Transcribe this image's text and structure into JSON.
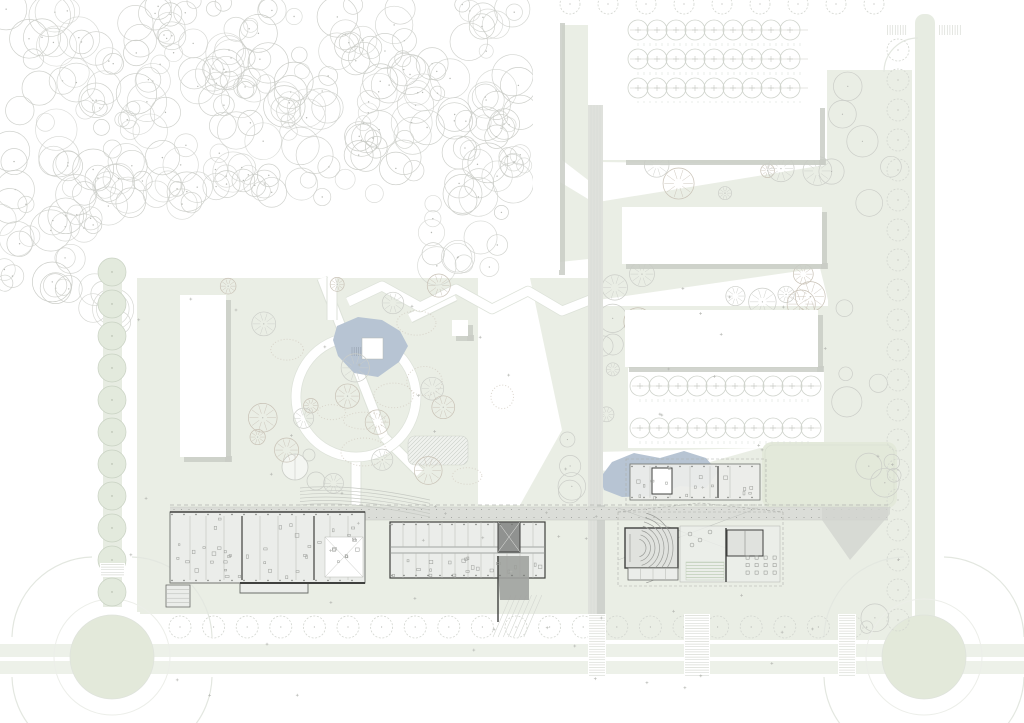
{
  "canvas": {
    "w": 1024,
    "h": 723
  },
  "palette": {
    "paper": "#ffffff",
    "green": "#eaeee5",
    "green2": "#e3e9da",
    "stripe": "#edf1e9",
    "band": "#e7ece2",
    "tree_fill": "#e3eadd",
    "tree_fill_stroke": "#c9d2c3",
    "tree_stroke": "#cbcdc8",
    "tree_dash": "#d3d6d0",
    "tree_warm": "#c8c1b5",
    "shadow": "#c9ccc6",
    "wall_dark": "#3f403e",
    "wall_mid": "#8a8c88",
    "hair": "#b6b8b3",
    "floor": "#ebedea",
    "floor2": "#e0e2de",
    "water": "#b7c4d3",
    "corridor": "#dbddd8",
    "spine": "#dfe1dc",
    "plaza": "#d2d5d0",
    "dot": "#9a9c97",
    "curb": "#e3e7e0",
    "mark": "#b4b6b1"
  },
  "forest": {
    "seed": 7,
    "r_min": 7,
    "r_max": 21,
    "regions": [
      {
        "x": 0,
        "y": 0,
        "w": 525,
        "h": 148,
        "n": 175
      },
      {
        "x": 0,
        "y": 148,
        "w": 95,
        "h": 150,
        "n": 34
      },
      {
        "x": 95,
        "y": 148,
        "w": 110,
        "h": 75,
        "n": 22
      },
      {
        "x": 205,
        "y": 148,
        "w": 230,
        "h": 50,
        "n": 26
      },
      {
        "x": 428,
        "y": 148,
        "w": 97,
        "h": 85,
        "n": 22
      },
      {
        "x": 55,
        "y": 288,
        "w": 90,
        "h": 35,
        "n": 7
      },
      {
        "x": 430,
        "y": 228,
        "w": 70,
        "h": 40,
        "n": 8
      }
    ],
    "exclude": {
      "cx": 262,
      "cy": 262,
      "rx": 158,
      "ry": 62
    }
  },
  "greens": [
    {
      "pts": [
        [
          137,
          278
        ],
        [
          620,
          278
        ],
        [
          620,
          612
        ],
        [
          137,
          612
        ]
      ]
    },
    {
      "pts": [
        [
          598,
          160
        ],
        [
          828,
          160
        ],
        [
          828,
          640
        ],
        [
          598,
          640
        ]
      ]
    },
    {
      "pts": [
        [
          827,
          70
        ],
        [
          912,
          70
        ],
        [
          912,
          640
        ],
        [
          827,
          640
        ]
      ]
    },
    {
      "pts": [
        [
          562,
          25
        ],
        [
          588,
          25
        ],
        [
          588,
          180
        ],
        [
          562,
          160
        ]
      ]
    },
    {
      "pts": [
        [
          560,
          182
        ],
        [
          598,
          205
        ],
        [
          598,
          258
        ],
        [
          560,
          262
        ]
      ]
    },
    {
      "pts": [
        [
          560,
          380
        ],
        [
          598,
          408
        ],
        [
          598,
          462
        ],
        [
          560,
          470
        ]
      ]
    },
    {
      "pts": [
        [
          140,
          597
        ],
        [
          880,
          597
        ],
        [
          880,
          614
        ],
        [
          140,
          614
        ]
      ]
    }
  ],
  "white_cuts": [
    {
      "pts": [
        [
          122,
          262
        ],
        [
          137,
          262
        ],
        [
          137,
          612
        ],
        [
          122,
          612
        ]
      ]
    },
    {
      "pts": [
        [
          598,
          162
        ],
        [
          825,
          165
        ],
        [
          598,
          202
        ]
      ]
    },
    {
      "pts": [
        [
          598,
          300
        ],
        [
          820,
          268
        ],
        [
          828,
          300
        ],
        [
          828,
          306
        ],
        [
          598,
          306
        ]
      ]
    },
    {
      "pts": [
        [
          628,
          368
        ],
        [
          824,
          368
        ],
        [
          824,
          448
        ],
        [
          628,
          448
        ]
      ]
    },
    {
      "pts": [
        [
          598,
          452
        ],
        [
          760,
          448
        ],
        [
          660,
          476
        ],
        [
          598,
          470
        ]
      ]
    },
    {
      "pts": [
        [
          478,
          278
        ],
        [
          530,
          278
        ],
        [
          562,
          430
        ],
        [
          520,
          505
        ],
        [
          478,
          505
        ]
      ]
    }
  ],
  "sport_field": {
    "x": 762,
    "y": 442,
    "w": 135,
    "h": 66,
    "rx": 10
  },
  "roads": {
    "left_band": {
      "x": 103,
      "y": 262,
      "w": 19,
      "h": 345
    },
    "right_band": {
      "x": 915,
      "y": 14,
      "w": 20,
      "h": 626
    },
    "south_stripes": [
      {
        "x": 0,
        "y": 644,
        "w": 1024,
        "h": 13
      },
      {
        "x": 0,
        "y": 661,
        "w": 1024,
        "h": 13
      }
    ],
    "roundabouts": [
      {
        "cx": 112,
        "cy": 657,
        "r": 42
      },
      {
        "cx": 924,
        "cy": 657,
        "r": 42
      }
    ],
    "corner_arc": {
      "x1": 884,
      "y1": 72,
      "x2": 918,
      "y2": 38
    }
  },
  "tree_rows": [
    {
      "kind": "filled",
      "axis": "v",
      "x": 112,
      "y0": 272,
      "y1": 592,
      "step": 32,
      "r": 14
    },
    {
      "kind": "dashed",
      "axis": "v",
      "x": 898,
      "y0": 50,
      "y1": 620,
      "step": 30,
      "r": 11
    },
    {
      "kind": "dashed",
      "axis": "h",
      "y": 627,
      "x0": 180,
      "x1": 856,
      "step": 33.6,
      "r": 11
    },
    {
      "kind": "dashed",
      "axis": "h",
      "y": 4,
      "x0": 570,
      "x1": 900,
      "step": 38,
      "r": 10
    },
    {
      "kind": "parking",
      "y": 30,
      "x0": 638,
      "x1": 800,
      "step": 19,
      "r": 10
    },
    {
      "kind": "parking",
      "y": 59,
      "x0": 638,
      "x1": 800,
      "step": 19,
      "r": 10
    },
    {
      "kind": "parking",
      "y": 88,
      "x0": 638,
      "x1": 800,
      "step": 19,
      "r": 10
    },
    {
      "kind": "parking",
      "y": 386,
      "x0": 640,
      "x1": 812,
      "step": 19,
      "r": 10
    },
    {
      "kind": "parking",
      "y": 428,
      "x0": 640,
      "x1": 812,
      "step": 19,
      "r": 10
    }
  ],
  "scatter_trees": [
    {
      "x": 640,
      "y": 162,
      "w": 180,
      "h": 42,
      "n": 6,
      "kind": "spoke"
    },
    {
      "x": 640,
      "y": 266,
      "w": 180,
      "h": 40,
      "n": 7,
      "kind": "spoke"
    },
    {
      "x": 830,
      "y": 80,
      "w": 66,
      "h": 550,
      "n": 16,
      "kind": "plain"
    },
    {
      "x": 600,
      "y": 312,
      "w": 26,
      "h": 54,
      "n": 3,
      "kind": "plain"
    },
    {
      "x": 560,
      "y": 430,
      "w": 40,
      "h": 78,
      "n": 4,
      "kind": "plain"
    },
    {
      "x": 205,
      "y": 282,
      "w": 460,
      "h": 215,
      "n": 24,
      "kind": "spoke"
    }
  ],
  "stipples": {
    "n": 9,
    "x": 230,
    "y": 300,
    "w": 320,
    "h": 180
  },
  "plus_marks": [
    {
      "x": 130,
      "y": 285,
      "w": 770,
      "h": 330,
      "n": 46
    },
    {
      "x": 150,
      "y": 596,
      "w": 740,
      "h": 100,
      "n": 18
    }
  ],
  "slabs": [
    {
      "x": 533,
      "y": 18,
      "w": 27,
      "h": 252,
      "shadow": "r"
    },
    {
      "x": 622,
      "y": 103,
      "w": 198,
      "h": 57,
      "shadow": "rb"
    },
    {
      "x": 622,
      "y": 207,
      "w": 200,
      "h": 57,
      "shadow": "rb"
    },
    {
      "x": 625,
      "y": 310,
      "w": 193,
      "h": 57,
      "shadow": "rb"
    },
    {
      "x": 180,
      "y": 295,
      "w": 46,
      "h": 162,
      "shadow": "rb"
    },
    {
      "x": 452,
      "y": 320,
      "w": 16,
      "h": 16,
      "shadow": "rb"
    }
  ],
  "park": {
    "ring": {
      "cx": 356,
      "cy": 397,
      "r": 60,
      "w": 9
    },
    "paths": [
      [
        [
          322,
          278
        ],
        [
          384,
          437
        ]
      ],
      [
        [
          332,
          278
        ],
        [
          332,
          320
        ]
      ],
      [
        [
          410,
          318
        ],
        [
          455,
          296
        ]
      ],
      [
        [
          384,
          437
        ],
        [
          420,
          473
        ]
      ],
      [
        [
          356,
          457
        ],
        [
          356,
          505
        ]
      ]
    ],
    "zigzag": [
      [
        348,
        302
      ],
      [
        382,
        286
      ],
      [
        420,
        307
      ],
      [
        456,
        289
      ],
      [
        492,
        309
      ],
      [
        528,
        291
      ],
      [
        562,
        311
      ],
      [
        600,
        296
      ]
    ],
    "pond1": [
      [
        337,
        326
      ],
      [
        358,
        317
      ],
      [
        382,
        320
      ],
      [
        400,
        331
      ],
      [
        408,
        346
      ],
      [
        399,
        362
      ],
      [
        378,
        377
      ],
      [
        354,
        373
      ],
      [
        338,
        356
      ],
      [
        333,
        340
      ]
    ],
    "pond1_square": {
      "x": 362,
      "y": 338,
      "w": 21,
      "h": 21
    },
    "pond2": [
      [
        600,
        478
      ],
      [
        612,
        462
      ],
      [
        634,
        453
      ],
      [
        660,
        458
      ],
      [
        684,
        451
      ],
      [
        706,
        458
      ],
      [
        718,
        472
      ],
      [
        706,
        488
      ],
      [
        680,
        486
      ],
      [
        652,
        496
      ],
      [
        622,
        497
      ],
      [
        604,
        490
      ]
    ],
    "greenhouse": {
      "x": 408,
      "y": 436,
      "w": 60,
      "h": 29,
      "rx": 7
    },
    "court": {
      "cx": 295,
      "cy": 467,
      "r": 13
    },
    "court2": {
      "cx": 316,
      "cy": 481,
      "r": 9
    },
    "court3": {
      "cx": 309,
      "cy": 455,
      "r": 6
    }
  },
  "campus": {
    "corridor": {
      "x": 170,
      "y": 507,
      "w": 718,
      "h": 13
    },
    "spine": {
      "x": 588,
      "y": 105,
      "w": 15,
      "h": 570
    },
    "plaza_wedge": [
      [
        822,
        507
      ],
      [
        890,
        507
      ],
      [
        890,
        514
      ],
      [
        850,
        560
      ],
      [
        822,
        520
      ]
    ],
    "plaza_x": [
      [
        618,
        560
      ],
      [
        758,
        508
      ],
      [
        618,
        508
      ],
      [
        758,
        560
      ]
    ],
    "canopy_y": 505,
    "diag_hatch": {
      "x": 493,
      "y": 595,
      "w": 36,
      "h": 42,
      "n": 7
    },
    "terraces": {
      "x0": 300,
      "x1": 430,
      "y0": 488,
      "rows": 6
    }
  },
  "plans": {
    "A": {
      "outline": [
        [
          170,
          512
        ],
        [
          365,
          512
        ],
        [
          365,
          583
        ],
        [
          308,
          583
        ],
        [
          308,
          593
        ],
        [
          240,
          593
        ],
        [
          240,
          583
        ],
        [
          170,
          583
        ]
      ],
      "partitions": [
        190,
        206,
        224,
        242,
        260,
        278,
        296,
        314,
        330,
        348
      ],
      "atrium": {
        "x": 325,
        "y": 537,
        "w": 38,
        "h": 40
      },
      "annex": {
        "x": 166,
        "y": 585,
        "w": 24,
        "h": 22
      },
      "furn": {
        "x": 175,
        "y": 518,
        "w": 185,
        "h": 60,
        "n": 42
      }
    },
    "B": {
      "x": 390,
      "y": 522,
      "w": 155,
      "h": 56,
      "corr_y1": 547,
      "corr_y2": 553,
      "part_step": 13,
      "core": {
        "x": 498,
        "y": 522,
        "w": 22,
        "h": 30
      },
      "wedge": [
        [
          497,
          556
        ],
        [
          529,
          556
        ],
        [
          529,
          600
        ],
        [
          500,
          600
        ]
      ],
      "furn": {
        "x": 392,
        "y": 555,
        "w": 150,
        "h": 21,
        "n": 20
      }
    },
    "C": {
      "aud": {
        "x": 625,
        "y": 528,
        "w": 53,
        "h": 40
      },
      "arc_c": [
        637,
        548
      ],
      "radii": [
        9,
        13.5,
        18,
        22.5,
        27,
        31.5,
        36
      ],
      "rooms": {
        "x": 628,
        "y": 568,
        "w": 50,
        "h": 12
      },
      "dash": {
        "x": 618,
        "y": 512,
        "w": 165,
        "h": 74
      }
    },
    "C2": {
      "floor": {
        "x": 680,
        "y": 526,
        "w": 100,
        "h": 56
      },
      "wall_x": 726,
      "room": {
        "x": 727,
        "y": 530,
        "w": 36,
        "h": 26
      },
      "tables": {
        "x0": 746,
        "x1": 774,
        "y0": 556,
        "y1": 578,
        "sx": 9,
        "sy": 7.5
      },
      "dots": [
        [
          690,
          534
        ],
        [
          700,
          540
        ],
        [
          710,
          532
        ],
        [
          692,
          545
        ]
      ],
      "terrace": {
        "x": 686,
        "y": 562,
        "w": 38,
        "h": 18
      }
    },
    "D": {
      "x": 630,
      "y": 464,
      "w": 130,
      "h": 36,
      "dash": {
        "x": 626,
        "y": 459,
        "w": 140,
        "h": 46
      },
      "core": {
        "x": 652,
        "y": 468,
        "w": 20,
        "h": 26
      },
      "parts": [
        650,
        670,
        690,
        710,
        730
      ],
      "furn": {
        "x": 635,
        "y": 467,
        "w": 120,
        "h": 30,
        "n": 16
      }
    }
  },
  "crosswalks": [
    {
      "x": 588,
      "y": 614,
      "w": 18,
      "h": 62,
      "dir": "h"
    },
    {
      "x": 838,
      "y": 614,
      "w": 18,
      "h": 62,
      "dir": "h"
    },
    {
      "x": 684,
      "y": 614,
      "w": 26,
      "h": 62,
      "dir": "h"
    },
    {
      "x": 100,
      "y": 563,
      "w": 25,
      "h": 14,
      "dir": "h"
    },
    {
      "x": 886,
      "y": 24,
      "w": 22,
      "h": 12,
      "dir": "v"
    },
    {
      "x": 938,
      "y": 24,
      "w": 24,
      "h": 12,
      "dir": "v"
    }
  ]
}
